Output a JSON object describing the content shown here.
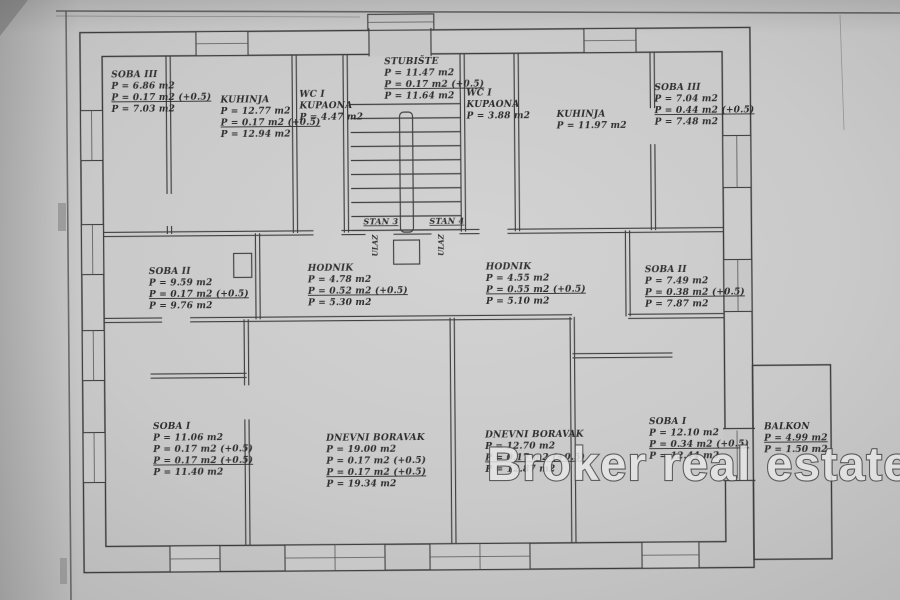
{
  "colors": {
    "paper": "#c9c9c9",
    "ink": "#3a3a3a",
    "label_text": "#2d2d2d",
    "watermark_fill": "#e6e6e6",
    "watermark_stroke": "#4a4a4a"
  },
  "watermark": {
    "text": "Broker real estate"
  },
  "apartments": {
    "left_label": "STAN 3",
    "right_label": "STAN 4",
    "entrance_label": "ULAZ"
  },
  "rooms": {
    "soba3_left": {
      "name_lines": [
        "SOBA III"
      ],
      "lines": [
        "P = 6.86 m2",
        "P = 0.17 m2 (+0.5)"
      ],
      "total": "P = 7.03 m2"
    },
    "kuhinja_left": {
      "name_lines": [
        "KUHINJA"
      ],
      "lines": [
        "P = 12.77 m2",
        "P = 0.17 m2 (+0.5)"
      ],
      "total": "P = 12.94 m2"
    },
    "wc_left": {
      "name_lines": [
        "WC I",
        "KUPAONA"
      ],
      "lines": [
        "P = 4.47 m2"
      ],
      "total": ""
    },
    "stubiste": {
      "name_lines": [
        "STUBIŠTE"
      ],
      "lines": [
        "P = 11.47 m2",
        "P = 0.17 m2 (+0.5)"
      ],
      "total": "P = 11.64 m2"
    },
    "wc_right": {
      "name_lines": [
        "WC I",
        "KUPAONA"
      ],
      "lines": [
        "P = 3.88 m2"
      ],
      "total": ""
    },
    "kuhinja_right": {
      "name_lines": [
        "KUHINJA"
      ],
      "lines": [
        "P = 11.97 m2"
      ],
      "total": ""
    },
    "soba3_right": {
      "name_lines": [
        "SOBA III"
      ],
      "lines": [
        "P = 7.04 m2",
        "P = 0.44 m2 (+0.5)"
      ],
      "total": "P = 7.48 m2"
    },
    "soba2_left": {
      "name_lines": [
        "SOBA II"
      ],
      "lines": [
        "P = 9.59 m2",
        "P = 0.17 m2 (+0.5)"
      ],
      "total": "P = 9.76 m2"
    },
    "hodnik_left": {
      "name_lines": [
        "HODNIK"
      ],
      "lines": [
        "P = 4.78 m2",
        "P = 0.52 m2 (+0.5)"
      ],
      "total": "P = 5.30 m2"
    },
    "hodnik_right": {
      "name_lines": [
        "HODNIK"
      ],
      "lines": [
        "P = 4.55 m2",
        "P = 0.55 m2 (+0.5)"
      ],
      "total": "P = 5.10 m2"
    },
    "soba2_right": {
      "name_lines": [
        "SOBA II"
      ],
      "lines": [
        "P = 7.49 m2",
        "P = 0.38 m2 (+0.5)"
      ],
      "total": "P = 7.87 m2"
    },
    "soba1_left": {
      "name_lines": [
        "SOBA I"
      ],
      "lines": [
        "P = 11.06 m2",
        "P = 0.17 m2 (+0.5)",
        "P = 0.17 m2 (+0.5)"
      ],
      "total": "P = 11.40 m2"
    },
    "dnevni_left": {
      "name_lines": [
        "DNEVNI BORAVAK"
      ],
      "lines": [
        "P = 19.00 m2",
        "P = 0.17 m2 (+0.5)",
        "P = 0.17 m2 (+0.5)"
      ],
      "total": "P = 19.34 m2"
    },
    "dnevni_right": {
      "name_lines": [
        "DNEVNI BORAVAK"
      ],
      "lines": [
        "P = 12.70 m2",
        "P = 0.17 m2 (+0.5)"
      ],
      "total": "P = 12.87 m2"
    },
    "soba1_right": {
      "name_lines": [
        "SOBA I"
      ],
      "lines": [
        "P = 12.10 m2",
        "P = 0.34 m2 (+0.5)"
      ],
      "total": "P = 12.44 m2"
    },
    "balkon": {
      "name_lines": [
        "BALKON"
      ],
      "lines": [
        "P = 4.99 m2"
      ],
      "total": "P = 1.50 m2"
    }
  }
}
